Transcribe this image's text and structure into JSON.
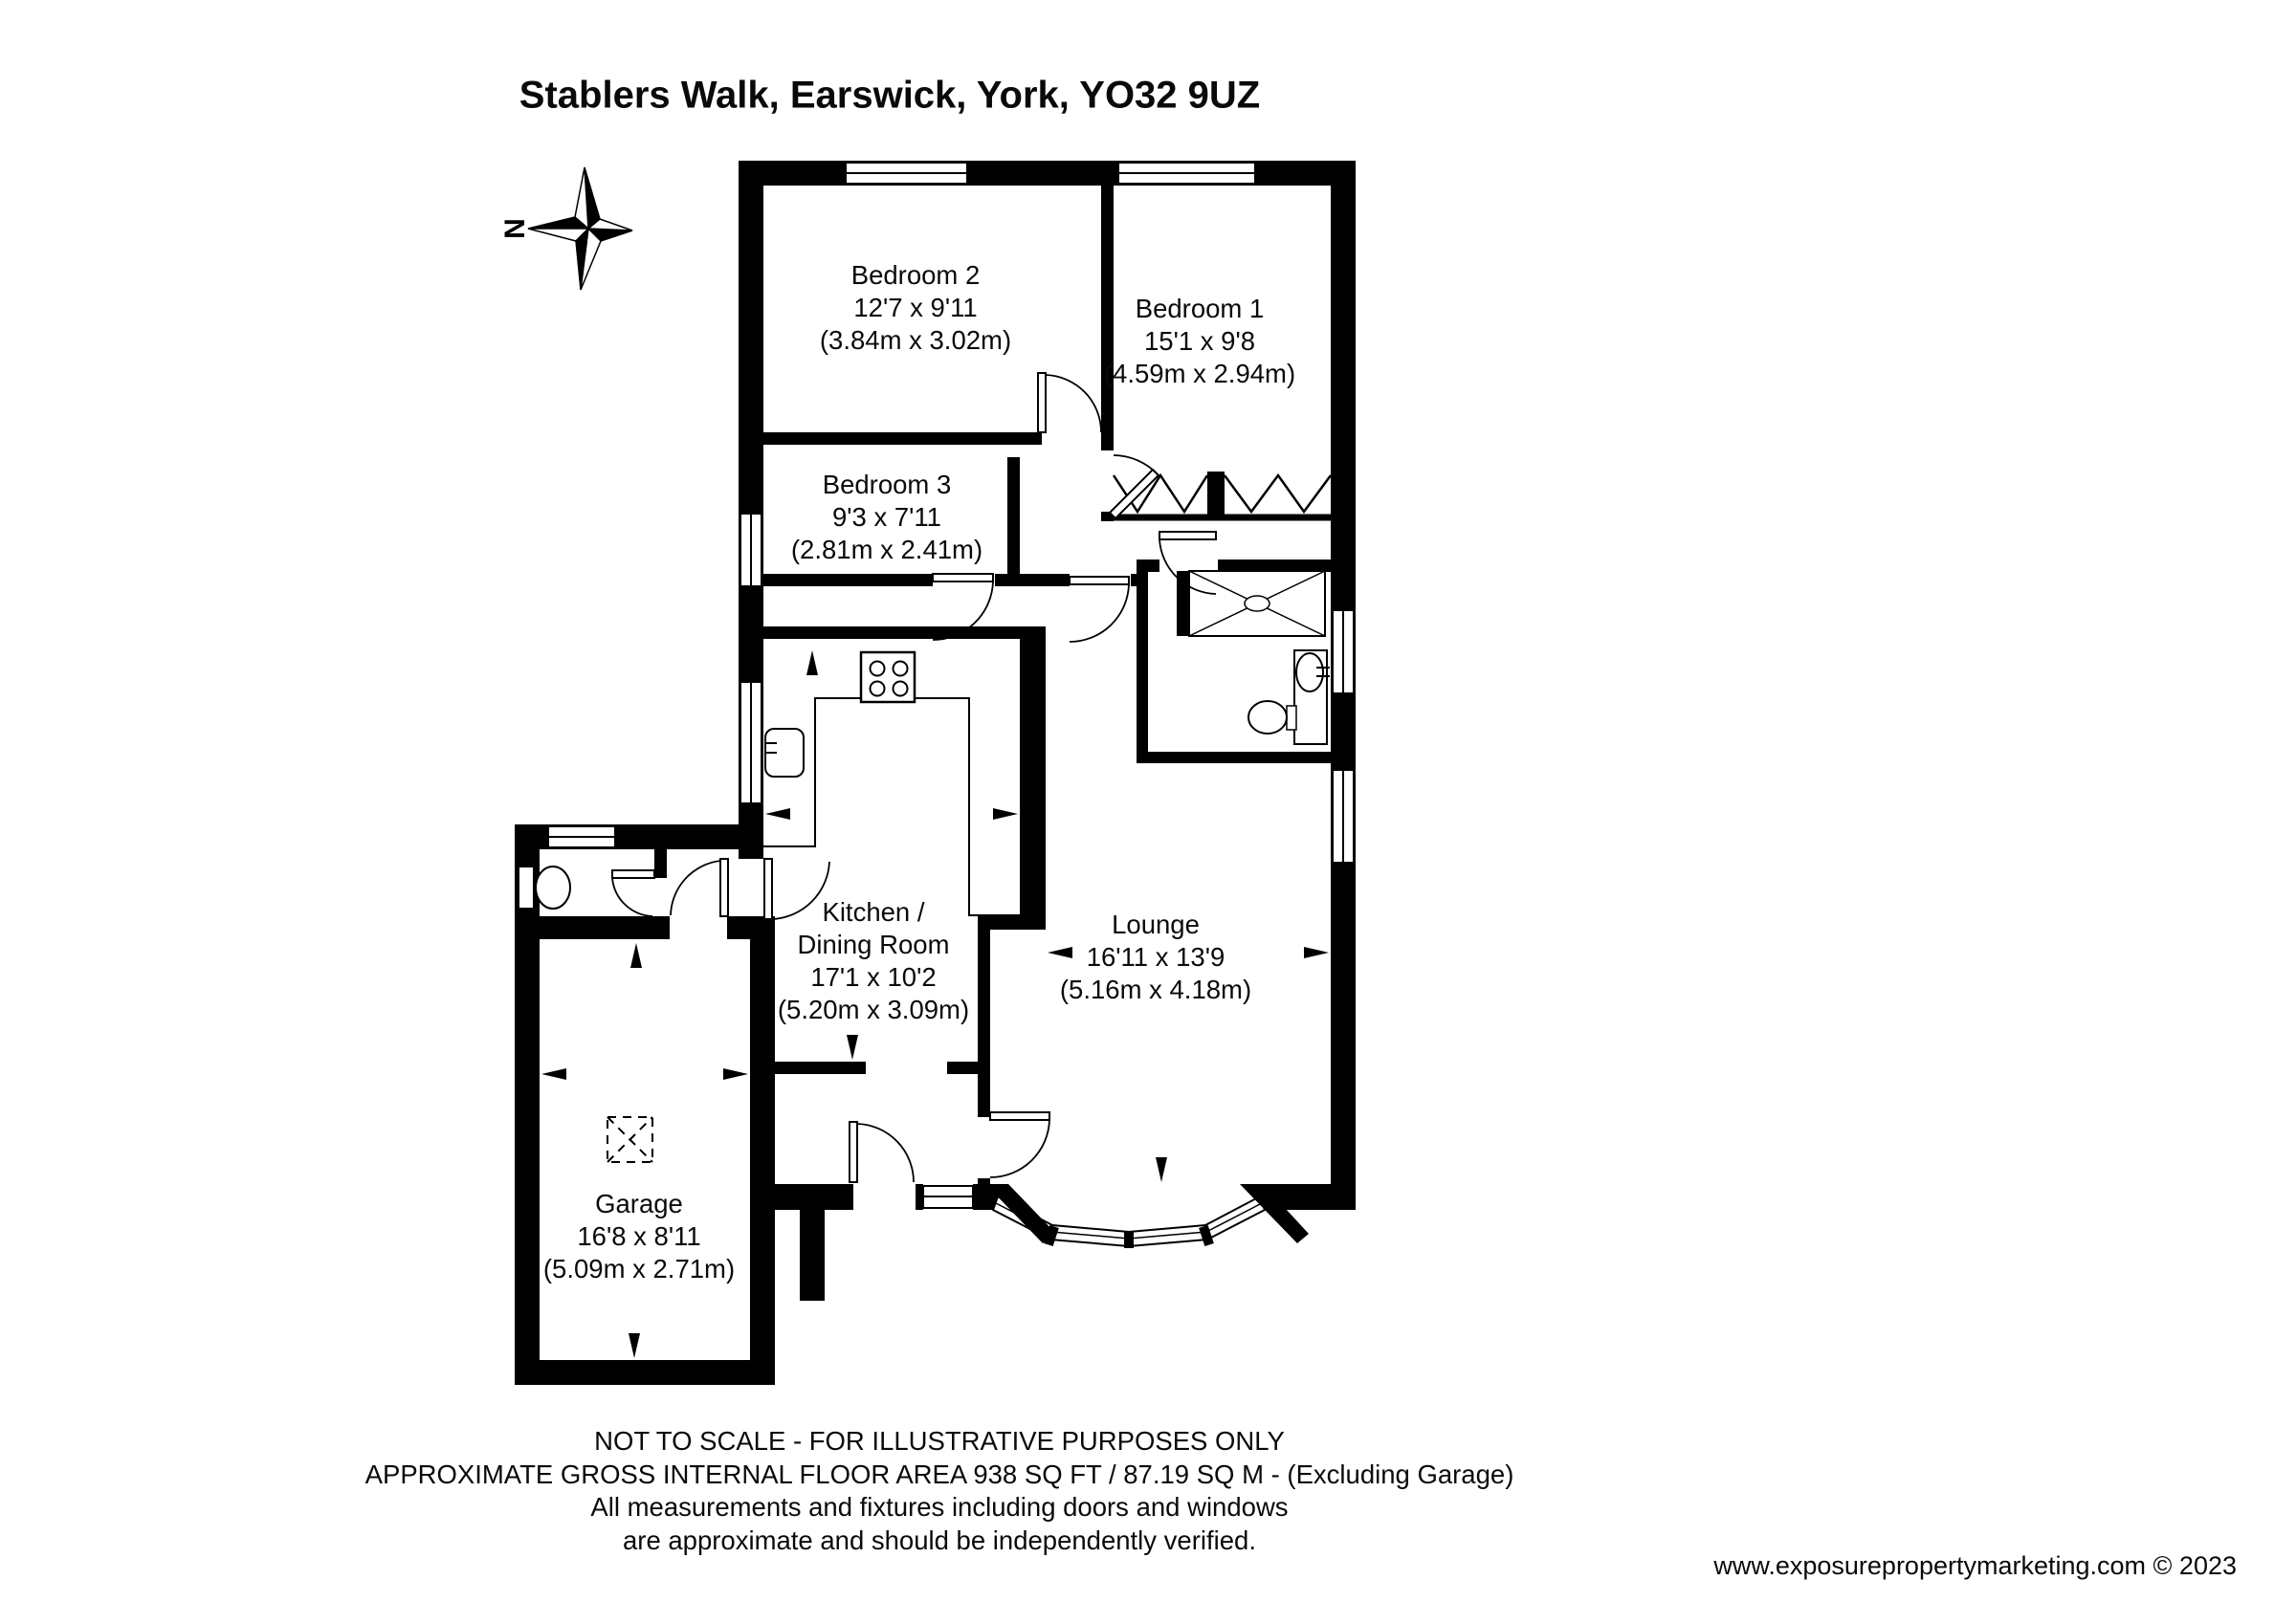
{
  "title": "Stablers Walk, Earswick, York, YO32 9UZ",
  "compass": {
    "north_label": "N"
  },
  "rooms": [
    {
      "id": "bedroom-2",
      "name": "Bedroom 2",
      "name2": null,
      "size_imperial": "12'7 x 9'11",
      "size_metric": "(3.84m x 3.02m)"
    },
    {
      "id": "bedroom-1",
      "name": "Bedroom 1",
      "name2": null,
      "size_imperial": "15'1 x 9'8",
      "size_metric": "(4.59m x 2.94m)"
    },
    {
      "id": "bedroom-3",
      "name": "Bedroom 3",
      "name2": null,
      "size_imperial": "9'3 x 7'11",
      "size_metric": "(2.81m x 2.41m)"
    },
    {
      "id": "kitchen-dining",
      "name": "Kitchen /",
      "name2": "Dining Room",
      "size_imperial": "17'1 x 10'2",
      "size_metric": "(5.20m x 3.09m)"
    },
    {
      "id": "lounge",
      "name": "Lounge",
      "name2": null,
      "size_imperial": "16'11 x 13'9",
      "size_metric": "(5.16m x 4.18m)"
    },
    {
      "id": "garage",
      "name": "Garage",
      "name2": null,
      "size_imperial": "16'8 x 8'11",
      "size_metric": "(5.09m x 2.71m)"
    }
  ],
  "footer": {
    "lines": [
      "NOT TO SCALE - FOR ILLUSTRATIVE PURPOSES ONLY",
      "APPROXIMATE GROSS INTERNAL FLOOR AREA 938 SQ FT / 87.19 SQ M - (Excluding Garage)",
      "All measurements and fixtures including doors and windows",
      "are approximate and should be independently verified."
    ],
    "copyright": "www.exposurepropertymarketing.com © 2023"
  }
}
